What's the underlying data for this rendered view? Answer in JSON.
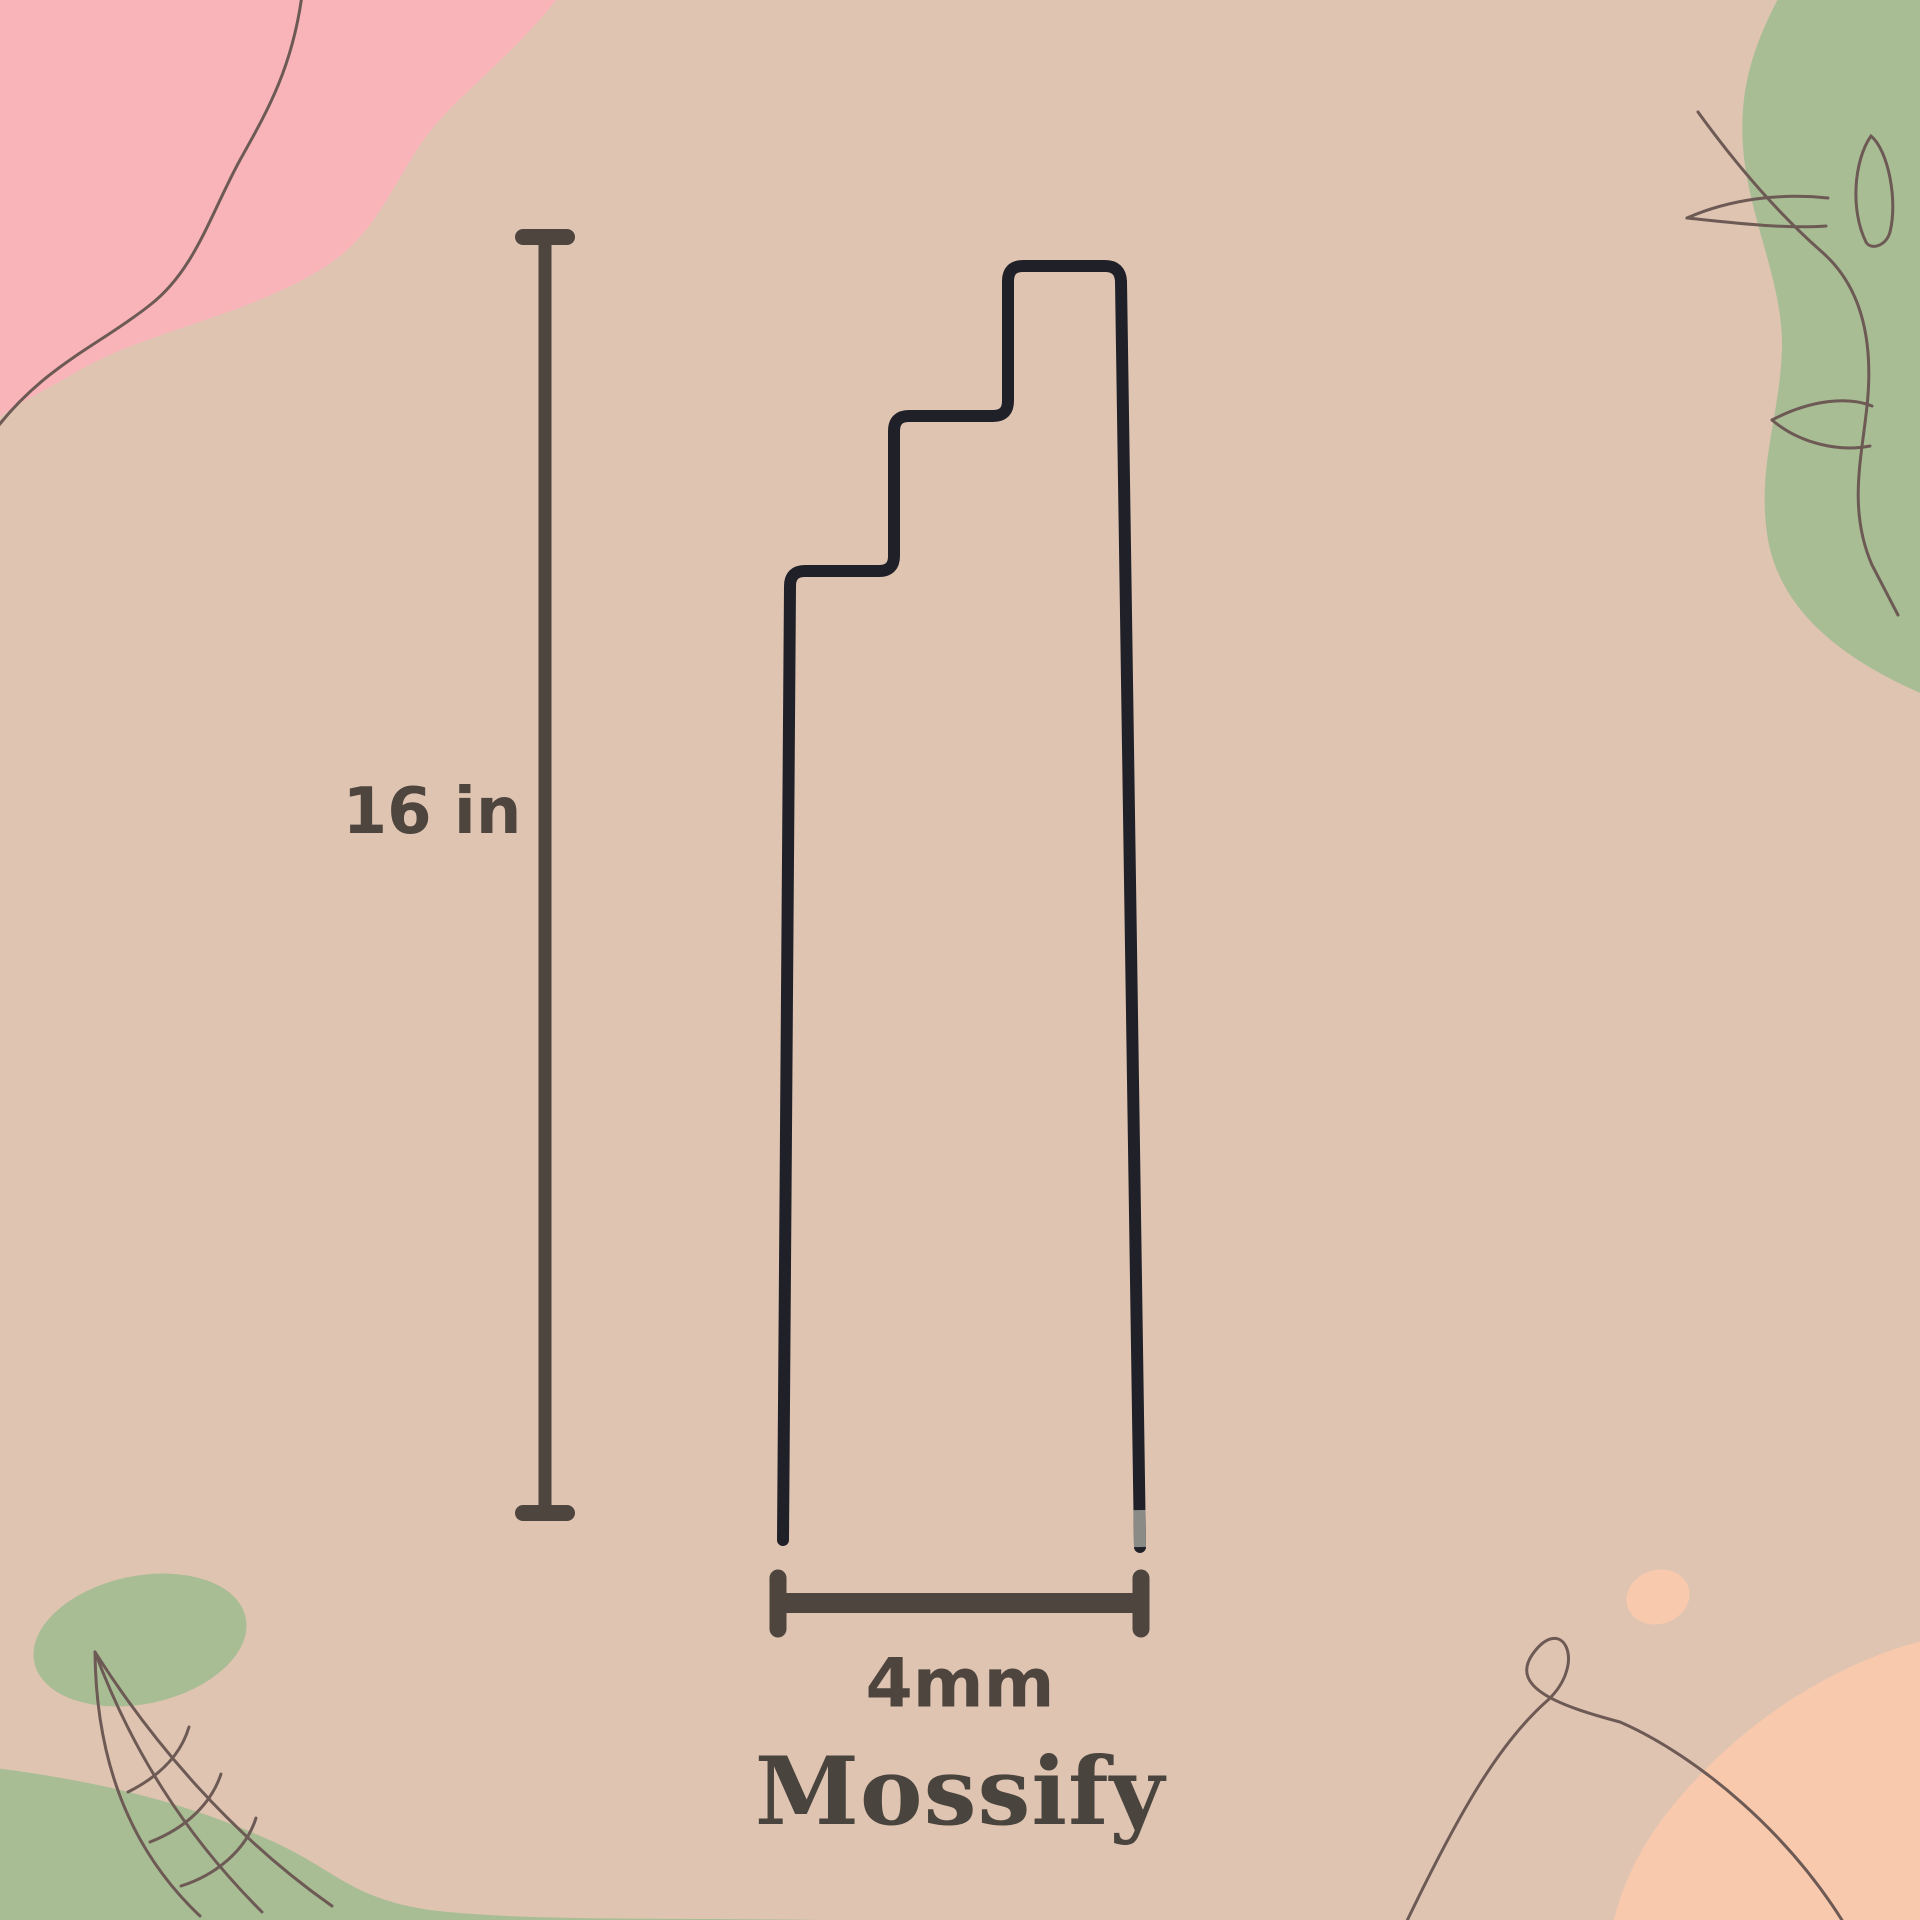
{
  "diagram": {
    "height_label": "16 in",
    "width_label": "4mm",
    "brand": "Mossify"
  },
  "colors": {
    "background": "#dfc4b2",
    "blob_pink": "#f9b4ba",
    "blob_green": "#a9bd95",
    "blob_peach": "#f8c9ad",
    "line_art": "#6d5a55",
    "dimension": "#4e453e",
    "brand_text": "#4a443e",
    "wire": "#202128",
    "wire_tip": "#8a8a86"
  }
}
